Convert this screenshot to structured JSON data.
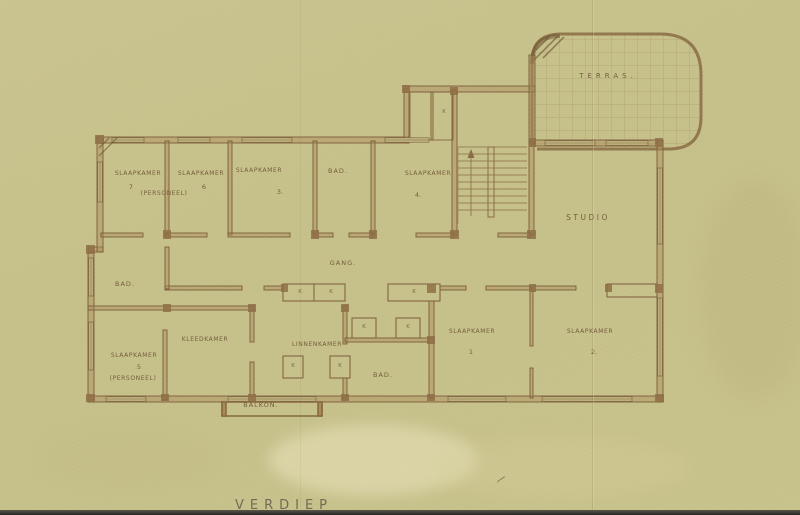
{
  "drawing": {
    "title": "VERDIEP",
    "closet_label": "K",
    "colors": {
      "paper": "#c7c18b",
      "ink": "#7b5c39",
      "wall_fill": "#ab8c5c",
      "label_text": "#6e5535",
      "photo_edge": "#2e2c26"
    },
    "rooms": {
      "terras": {
        "label": "TERRAS."
      },
      "studio": {
        "label": "STUDIO"
      },
      "gang": {
        "label": "GANG."
      },
      "slaapkamer_7": {
        "label": "SLAAPKAMER",
        "number": "7",
        "sublabel": "(PERSONEEL)"
      },
      "slaapkamer_6": {
        "label": "SLAAPKAMER",
        "number": "6"
      },
      "slaapkamer_3": {
        "label": "SLAAPKAMER",
        "number": "3."
      },
      "bad_boven": {
        "label": "BAD."
      },
      "slaapkamer_4": {
        "label": "SLAAPKAMER",
        "number": "4."
      },
      "bad_links": {
        "label": "BAD."
      },
      "slaapkamer_5": {
        "label": "SLAAPKAMER",
        "number": "5",
        "sublabel": "(PERSONEEL)"
      },
      "kleedkamer": {
        "label": "KLEEDKAMER"
      },
      "linnenkamer": {
        "label": "LINNENKAMER"
      },
      "bad_onder": {
        "label": "BAD."
      },
      "balkon": {
        "label": "BALKON."
      },
      "slaapkamer_1": {
        "label": "SLAAPKAMER",
        "number": "1"
      },
      "slaapkamer_2": {
        "label": "SLAAPKAMER",
        "number": "2."
      }
    }
  }
}
